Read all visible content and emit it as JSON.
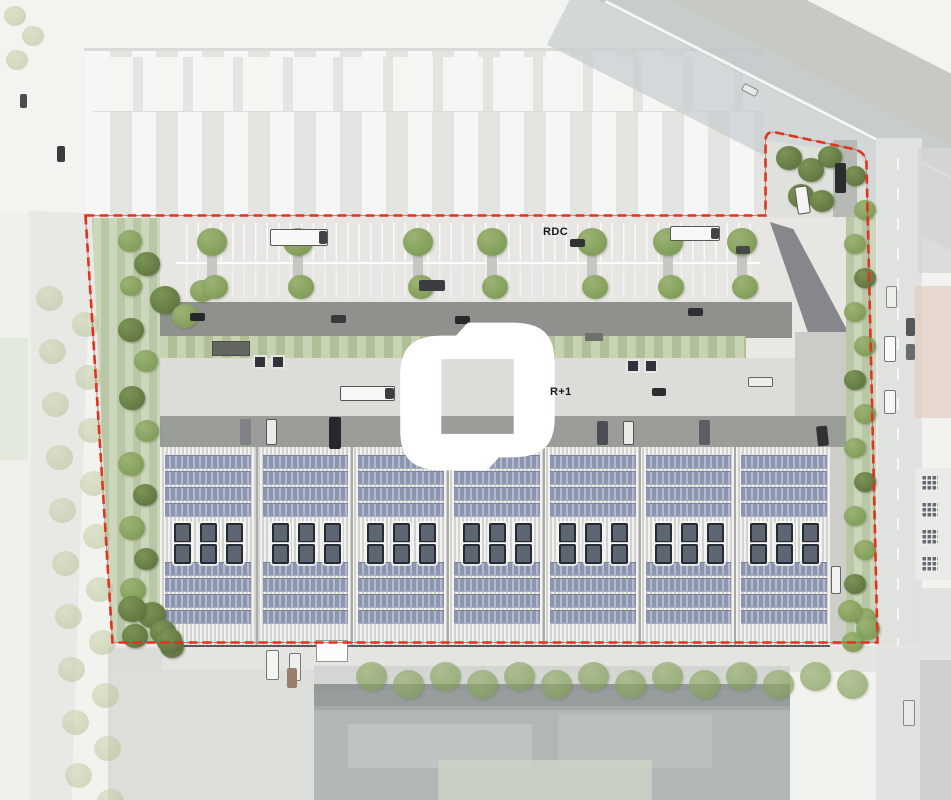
{
  "plan": {
    "labels": {
      "ground_floor": "RDC",
      "upper_floor": "R+1"
    },
    "boundary_color": "#e2331f",
    "logo_color": "#ffffff",
    "solar_panel_color": "#97a0b7",
    "landscape_color": "#c7d2b3"
  }
}
